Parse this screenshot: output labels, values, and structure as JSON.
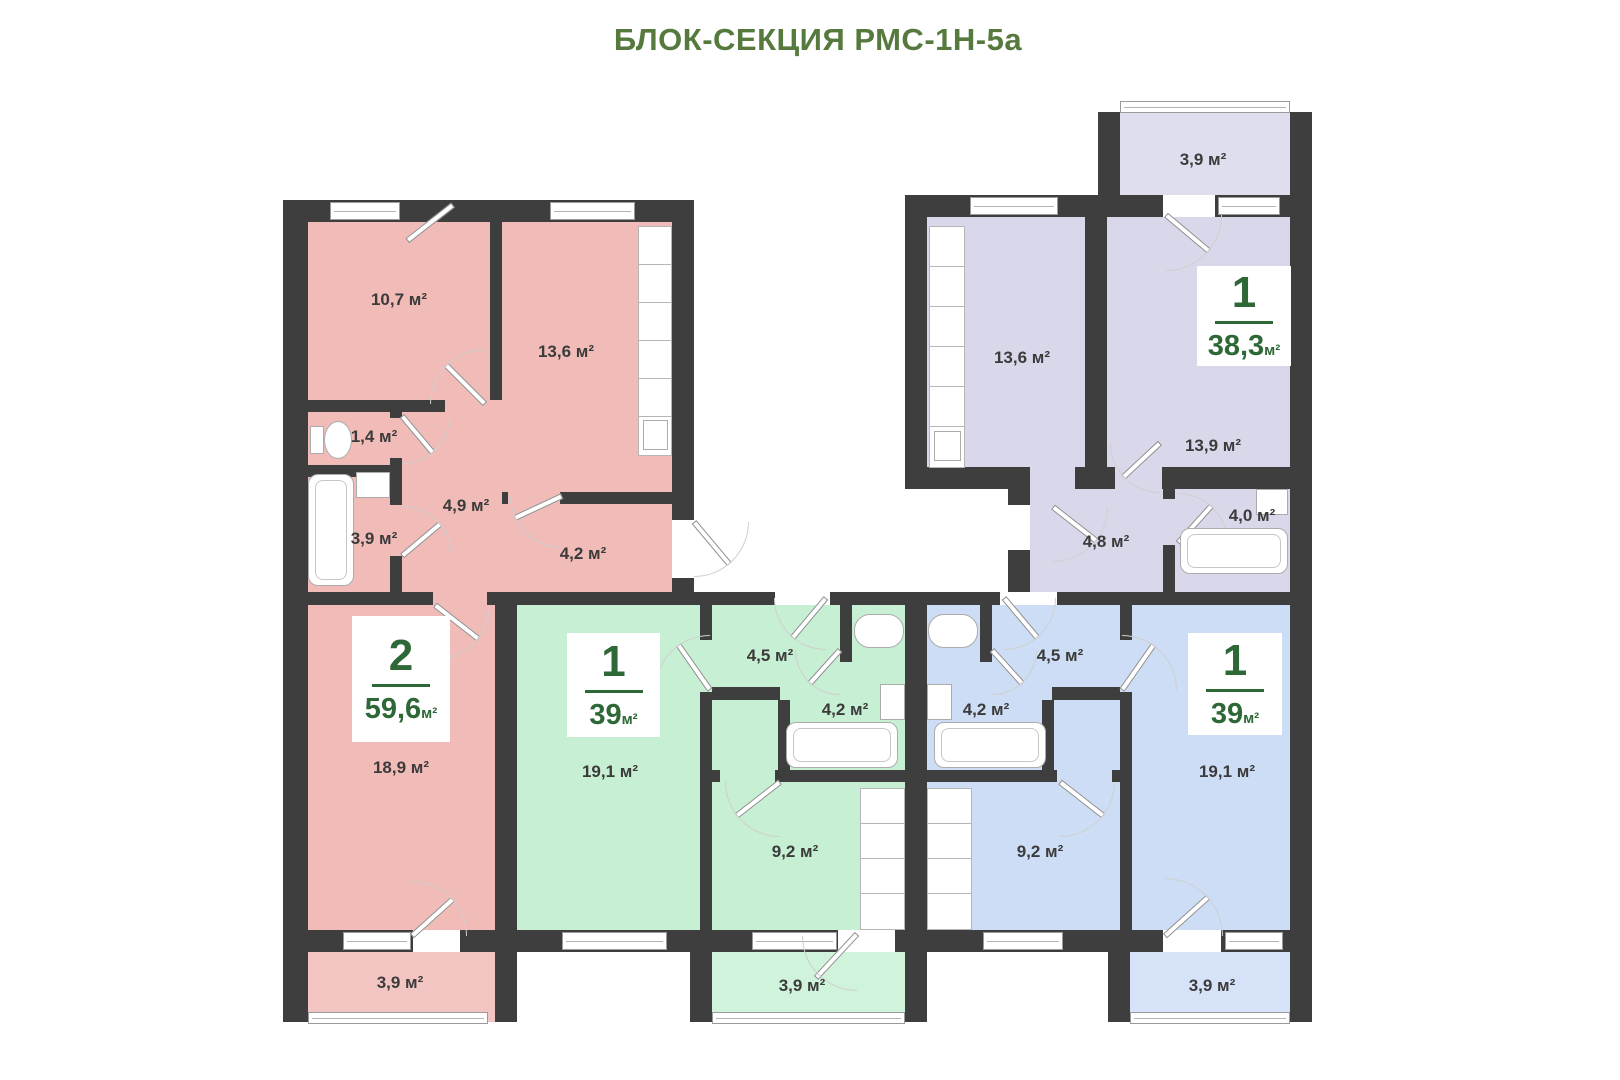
{
  "title": "БЛОК-СЕКЦИЯ РМС-1Н-5а",
  "unit": "м²",
  "apartments": {
    "pink": {
      "number": "2",
      "total": "59,6",
      "rooms": {
        "room1": "10,7 м²",
        "kitchen": "13,6 м²",
        "wc": "1,4 м²",
        "bath": "3,9 м²",
        "hall": "4,9 м²",
        "corridor": "4,2 м²",
        "living": "18,9 м²",
        "balcony": "3,9 м²"
      }
    },
    "green": {
      "number": "1",
      "total": "39",
      "rooms": {
        "living": "19,1 м²",
        "hall": "4,5 м²",
        "bath": "4,2 м²",
        "kitchen": "9,2 м²",
        "balcony": "3,9 м²"
      }
    },
    "lavender": {
      "number": "1",
      "total": "38,3",
      "rooms": {
        "balcony": "3,9 м²",
        "kitchen": "13,6 м²",
        "room": "13,9 м²",
        "hall": "4,8 м²",
        "bath": "4,0 м²"
      }
    },
    "blue": {
      "number": "1",
      "total": "39",
      "rooms": {
        "hall": "4,5 м²",
        "bath": "4,2 м²",
        "kitchen": "9,2 м²",
        "living": "19,1 м²",
        "balcony": "3,9 м²"
      }
    }
  },
  "colors": {
    "wall": "#3e3e3e",
    "title_green": "#567a3e",
    "badge_green": "#2e6837",
    "pink": "#f1bbb8",
    "pink_balcony": "#f3c5c2",
    "green": "#c7efd3",
    "green_balcony": "#cff3db",
    "lavender": "#d8d8ea",
    "lavender_balcony": "#dedeef",
    "blue": "#cdddf5",
    "blue_balcony": "#d6e2f8"
  }
}
